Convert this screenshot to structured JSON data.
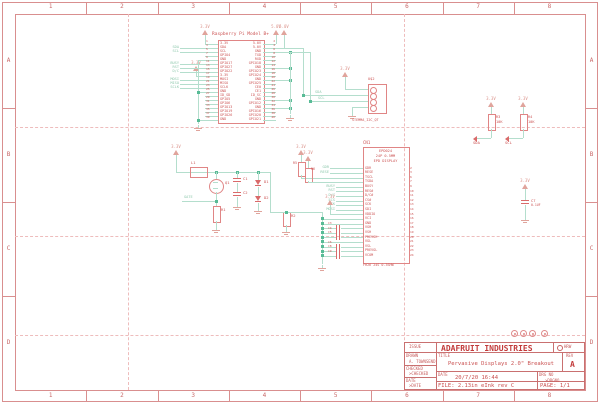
{
  "frame": {
    "columns": [
      "1",
      "2",
      "3",
      "4",
      "5",
      "6",
      "7",
      "8"
    ],
    "rows": [
      "A",
      "B",
      "C",
      "D"
    ]
  },
  "colors": {
    "frame": "#d98f8f",
    "component": "#e08585",
    "component_text": "#cc5454",
    "net": "#b4decd",
    "junction": "#58bb96",
    "net_label": "#90c9ae",
    "supply": "#dc968e"
  },
  "pi": {
    "title": "Raspberry Pi Model B+",
    "left_pins": [
      "3.3V",
      "SDA",
      "SCL",
      "GPIO4",
      "GND",
      "GPIO17",
      "GPIO27",
      "GPIO22",
      "3.3V",
      "MOSI",
      "MISO",
      "SCLK",
      "GND",
      "ID_SD",
      "GPIO5",
      "GPIO6",
      "GPIO13",
      "GPIO19",
      "GPIO26",
      "GND"
    ],
    "right_pins": [
      "5.0V",
      "5.0V",
      "GND",
      "TXD",
      "RXD",
      "GPIO18",
      "GND",
      "GPIO23",
      "GPIO24",
      "GND",
      "GPIO25",
      "CE0",
      "CE1",
      "ID_SC",
      "GND",
      "GPIO12",
      "GND",
      "GPIO16",
      "GPIO20",
      "GPIO21"
    ],
    "left_pin_numbers": [
      "1",
      "3",
      "5",
      "7",
      "9",
      "11",
      "13",
      "15",
      "17",
      "19",
      "21",
      "23",
      "25",
      "27",
      "29",
      "31",
      "33",
      "35",
      "37",
      "39"
    ],
    "right_pin_numbers": [
      "2",
      "4",
      "6",
      "8",
      "10",
      "12",
      "14",
      "16",
      "18",
      "20",
      "22",
      "24",
      "26",
      "28",
      "30",
      "32",
      "34",
      "36",
      "38",
      "40"
    ],
    "left_net_labels": [
      {
        "row": 1,
        "label": "SDA"
      },
      {
        "row": 2,
        "label": "SCL"
      },
      {
        "row": 5,
        "label": "BUSY"
      },
      {
        "row": 6,
        "label": "RST"
      },
      {
        "row": 7,
        "label": "D/C"
      },
      {
        "row": 9,
        "label": "MOSI"
      },
      {
        "row": 10,
        "label": "MISO"
      },
      {
        "row": 11,
        "label": "SCLK"
      }
    ],
    "supply_3v3": "3.3V",
    "supply_5v": "5.0V"
  },
  "qt": {
    "ref": "U$2",
    "bottom_label": "STEMMA_I2C_QT",
    "sda_label": "SDA",
    "scl_label": "SCL",
    "supply": "3.3V"
  },
  "boost": {
    "supply": "3.3V",
    "gate_label": "GATE",
    "parts": {
      "l1": "L1",
      "q1": "Q1",
      "r1": "R1",
      "c1": "C1",
      "c2": "C2",
      "d1": "D1",
      "d2": "D2",
      "r2": "R2"
    }
  },
  "display": {
    "ref": "CN1",
    "header": [
      "EPD024",
      "24P 0.5MM",
      "EPD DISPLAY"
    ],
    "pins": [
      "GDR",
      "RESE",
      "TSCL",
      "TSDA",
      "BUSY",
      "RES#",
      "D/C#",
      "CS#",
      "SCK",
      "SDI",
      "VDDIO",
      "VCI",
      "GND",
      "VGH",
      "VSH",
      "PREVGH",
      "VGL",
      "VSL",
      "PREVGL",
      "VCOM"
    ],
    "pin_numbers": [
      "2",
      "3",
      "6",
      "7",
      "9",
      "10",
      "11",
      "12",
      "13",
      "14",
      "15",
      "16",
      "17",
      "18",
      "19",
      "20",
      "21",
      "22",
      "23",
      "24"
    ],
    "net_labels": {
      "gdr": "GDR",
      "rese": "RESE",
      "busy": "BUSY",
      "rst": "RST",
      "dc": "D/C",
      "ecs": "ECS",
      "sck": "SCK",
      "mosi": "MOSI"
    },
    "pullup_refs": [
      "R5",
      "R6"
    ],
    "cap_refs": [
      "C3",
      "C4",
      "C5",
      "C6",
      "C8",
      "C9"
    ],
    "part_line": "FH26 24S 0.3SHW",
    "supply": "3.3V"
  },
  "pullups": {
    "supply": "3.3V",
    "r1_ref": "R3",
    "r1_val": "10K",
    "r2_ref": "R4",
    "r2_val": "10K",
    "flag1": "SDA",
    "flag2": "SCL"
  },
  "cap7": {
    "ref": "C7",
    "val": "0.1UF",
    "supply": "3.3V"
  },
  "mounting_holes": {
    "count": 4
  },
  "title_block": {
    "issue": "ISSUE",
    "drawn_label": "DRAWN",
    "drawn_value": "A. TOWNSEND",
    "checked_label": "CHECKED",
    "checked_value": ">CHECKED",
    "date_label": "DATE",
    "date_value": ">DATE",
    "company": "ADAFRUIT INDUSTRIES",
    "logo": "HRW",
    "title_label": "TITLE",
    "title_value": "Pervasive Displays 2.0\" Breakout",
    "rev_label": "REV",
    "rev_value": "A",
    "date2_label": "DATE",
    "date2_value": "20/7/20 16:44",
    "drg_label": "DRG NO",
    "drg_value": ">DRGNO",
    "file_value": "FILE: 2.13in eInk rev C",
    "page_value": "PAGE: 1/1"
  }
}
